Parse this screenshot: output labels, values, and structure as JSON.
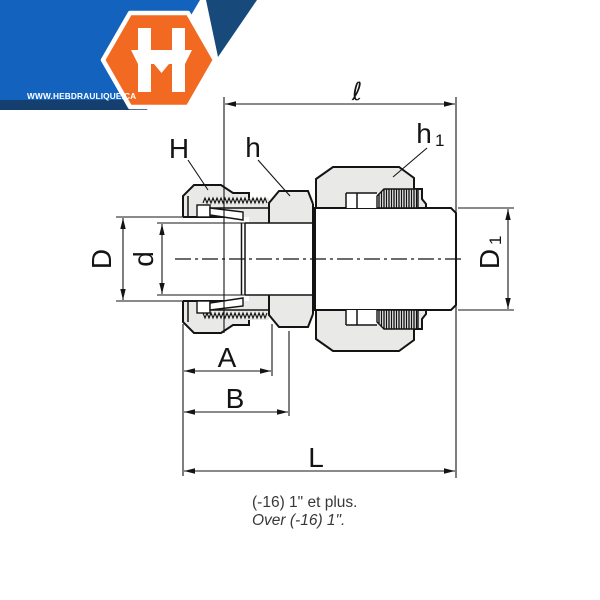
{
  "logo": {
    "website": "WWW.HEBDRAULIQUE.CA",
    "monogram": "H",
    "colors": {
      "orange": "#F26A22",
      "blue": "#1363BE",
      "navy_stripe": "#153F6E",
      "navy_corner": "#17497B"
    }
  },
  "diagram": {
    "type": "technical-drawing",
    "subject": "compression tube fitting male connector, cross-section side view",
    "part_fill_color": "#E9E9E7",
    "line_color": "#141414",
    "labels": {
      "ell": "ℓ",
      "H": "H",
      "h": "h",
      "h1": "h",
      "h1_sub": "1",
      "D": "D",
      "d": "d",
      "D1": "D",
      "D1_sub": "1",
      "A": "A",
      "B": "B",
      "L": "L"
    }
  },
  "caption": {
    "line1": "(-16) 1\" et plus.",
    "line2": "Over (-16) 1\"."
  }
}
